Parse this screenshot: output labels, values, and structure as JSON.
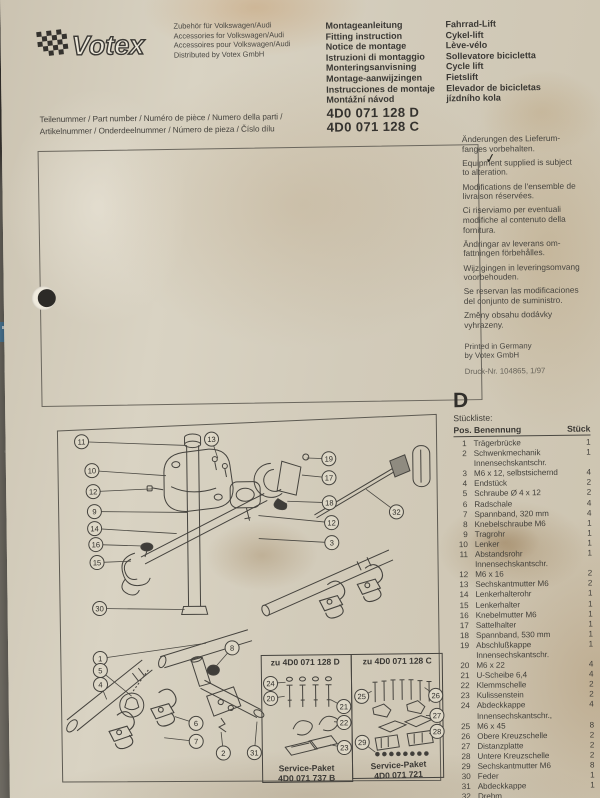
{
  "header": {
    "brand": "Votex",
    "distributor_lines": [
      "Zubehör für Volkswagen/Audi",
      "Accessories for Volkswagen/Audi",
      "Accessoires pour Volkswagen/Audi",
      "Distributed by Votex GmbH"
    ],
    "instruction_titles": [
      "Montageanleitung",
      "Fitting instruction",
      "Notice de montage",
      "Istruzioni di montaggio",
      "Monteringsanvisning",
      "Montage-aanwijzingen",
      "Instrucciones de montaje",
      "Montážní návod"
    ],
    "product_names": [
      "Fahrrad-Lift",
      "Cykel-lift",
      "Lève-vélo",
      "Sollevatore bicicletta",
      "Cycle lift",
      "Fietslift",
      "Elevador de bicicletas",
      "jízdního kola"
    ],
    "part_number_labels": [
      "Teilenummer / Part number / Numéro de pièce / Numero della parti /",
      "Artikelnummer / Onderdeelnummer / Número de pieza / Číslo dílu"
    ],
    "part_numbers": [
      "4D0 071 128 D",
      "4D0 071 128 C"
    ]
  },
  "notices": {
    "paragraphs": [
      "Änderungen des Lieferum-\nfanges vorbehalten.",
      "Equipment supplied is subject\nto alteration.",
      "Modifications de l'ensemble de\nlivraison réservées.",
      "Ci riserviamo per eventuali\nmodifiche al contenuto della\nfornitura.",
      "Ändringar av leverans om-\nfattningen förbehålles.",
      "Wijzigingen in leveringsomvang\nvoorbehouden.",
      "Se reservan las modificaciones\ndel conjunto de suministro.",
      "Změny obsahu dodávky\nvyhrazeny."
    ],
    "printed": "Printed in Germany\nby Votex GmbH",
    "print_number": "Druck-Nr. 104865, 1/97"
  },
  "parts_list": {
    "section_letter": "D",
    "title": "Stückliste:",
    "col_pos_name": "Pos. Benennung",
    "col_qty": "Stück",
    "rows": [
      {
        "pos": "1",
        "name": "Trägerbrücke",
        "qty": "1"
      },
      {
        "pos": "2",
        "name": "Schwenkmechanik",
        "qty": "1"
      },
      {
        "pos": "3",
        "name": "Innensechskantschr.\nM6 x 12, selbstsichernd",
        "qty": "4"
      },
      {
        "pos": "4",
        "name": "Endstück",
        "qty": "2"
      },
      {
        "pos": "5",
        "name": "Schraube Ø 4 x 12",
        "qty": "2"
      },
      {
        "pos": "6",
        "name": "Radschale",
        "qty": "4"
      },
      {
        "pos": "7",
        "name": "Spannband, 320 mm",
        "qty": "4"
      },
      {
        "pos": "8",
        "name": "Knebelschraube M6",
        "qty": "1"
      },
      {
        "pos": "9",
        "name": "Tragrohr",
        "qty": "1"
      },
      {
        "pos": "10",
        "name": "Lenker",
        "qty": "1"
      },
      {
        "pos": "11",
        "name": "Abstandsrohr",
        "qty": "1"
      },
      {
        "pos": "12",
        "name": "Innensechskantschr.\nM6 x 16",
        "qty": "2"
      },
      {
        "pos": "13",
        "name": "Sechskantmutter M6",
        "qty": "2"
      },
      {
        "pos": "14",
        "name": "Lenkerhalterohr",
        "qty": "1"
      },
      {
        "pos": "15",
        "name": "Lenkerhalter",
        "qty": "1"
      },
      {
        "pos": "16",
        "name": "Knebelmutter M6",
        "qty": "1"
      },
      {
        "pos": "17",
        "name": "Sattelhalter",
        "qty": "1"
      },
      {
        "pos": "18",
        "name": "Spannband, 530 mm",
        "qty": "1"
      },
      {
        "pos": "19",
        "name": "Abschlußkappe",
        "qty": "1"
      },
      {
        "pos": "20",
        "name": "Innensechskantschr.\nM6 x 22",
        "qty": "4"
      },
      {
        "pos": "21",
        "name": "U-Scheibe 6,4",
        "qty": "4"
      },
      {
        "pos": "22",
        "name": "Klemmschelle",
        "qty": "2"
      },
      {
        "pos": "23",
        "name": "Kulissenstein",
        "qty": "2"
      },
      {
        "pos": "24",
        "name": "Abdeckkappe",
        "qty": "4"
      },
      {
        "pos": "25",
        "name": "Innensechskantschr.,\nM6 x 45",
        "qty": "8"
      },
      {
        "pos": "26",
        "name": "Obere Kreuzschelle",
        "qty": "2"
      },
      {
        "pos": "27",
        "name": "Distanzplatte",
        "qty": "2"
      },
      {
        "pos": "28",
        "name": "Untere Kreuzschelle",
        "qty": "2"
      },
      {
        "pos": "29",
        "name": "Sechskantmutter M6",
        "qty": "8"
      },
      {
        "pos": "30",
        "name": "Feder",
        "qty": "1"
      },
      {
        "pos": "31",
        "name": "Abdeckkappe",
        "qty": "1"
      },
      {
        "pos": "32",
        "name": "Drehm",
        "qty": ""
      }
    ]
  },
  "diagram": {
    "service_box_d": {
      "title": "zu 4D0 071 128 D",
      "label1": "Service-Paket",
      "label2": "4D0 071 737 B"
    },
    "service_box_c": {
      "title": "zu 4D0 071 128 C",
      "label1": "Service-Paket",
      "label2": "4D0 071 721"
    },
    "callouts": [
      {
        "n": "11",
        "x": 76,
        "y": 444,
        "tx": 181,
        "ty": 449
      },
      {
        "n": "13",
        "x": 206,
        "y": 443,
        "tx": 212,
        "ty": 462
      },
      {
        "n": "10",
        "x": 86,
        "y": 473,
        "tx": 160,
        "ty": 479
      },
      {
        "n": "12",
        "x": 87,
        "y": 494,
        "tx": 146,
        "ty": 492
      },
      {
        "n": "9",
        "x": 88,
        "y": 514,
        "tx": 181,
        "ty": 516
      },
      {
        "n": "14",
        "x": 88,
        "y": 531,
        "tx": 170,
        "ty": 537
      },
      {
        "n": "16",
        "x": 89,
        "y": 547,
        "tx": 136,
        "ty": 549
      },
      {
        "n": "15",
        "x": 90,
        "y": 565,
        "tx": 124,
        "ty": 564
      },
      {
        "n": "30",
        "x": 92,
        "y": 611,
        "tx": 177,
        "ty": 613
      },
      {
        "n": "1",
        "x": 92,
        "y": 661,
        "tx": 198,
        "ty": 647
      },
      {
        "n": "5",
        "x": 92,
        "y": 673,
        "tx": 123,
        "ty": 699
      },
      {
        "n": "4",
        "x": 92,
        "y": 687,
        "tx": 98,
        "ty": 702
      },
      {
        "n": "8",
        "x": 224,
        "y": 652,
        "tx": 207,
        "ty": 671
      },
      {
        "n": "6",
        "x": 187,
        "y": 727,
        "tx": 166,
        "ty": 720
      },
      {
        "n": "7",
        "x": 187,
        "y": 745,
        "tx": 155,
        "ty": 741
      },
      {
        "n": "2",
        "x": 214,
        "y": 757,
        "tx": 212,
        "ty": 736
      },
      {
        "n": "31",
        "x": 245,
        "y": 757,
        "tx": 248,
        "ty": 726
      },
      {
        "n": "19",
        "x": 323,
        "y": 464,
        "tx": 301,
        "ty": 463
      },
      {
        "n": "17",
        "x": 323,
        "y": 483,
        "tx": 296,
        "ty": 480
      },
      {
        "n": "18",
        "x": 323,
        "y": 508,
        "tx": 281,
        "ty": 506
      },
      {
        "n": "12",
        "x": 325,
        "y": 528,
        "tx": 252,
        "ty": 520
      },
      {
        "n": "3",
        "x": 325,
        "y": 548,
        "tx": 252,
        "ty": 543
      },
      {
        "n": "32",
        "x": 390,
        "y": 518,
        "tx": 360,
        "ty": 495
      },
      {
        "n": "24",
        "x": 262,
        "y": 688,
        "tx": 277,
        "ty": 687
      },
      {
        "n": "20",
        "x": 262,
        "y": 703,
        "tx": 276,
        "ty": 701
      },
      {
        "n": "21",
        "x": 335,
        "y": 712,
        "tx": 322,
        "ty": 705
      },
      {
        "n": "22",
        "x": 335,
        "y": 728,
        "tx": 325,
        "ty": 727
      },
      {
        "n": "23",
        "x": 335,
        "y": 753,
        "tx": 321,
        "ty": 750
      },
      {
        "n": "25",
        "x": 353,
        "y": 702,
        "tx": 363,
        "ty": 697
      },
      {
        "n": "26",
        "x": 427,
        "y": 702,
        "tx": 416,
        "ty": 694
      },
      {
        "n": "27",
        "x": 428,
        "y": 722,
        "tx": 417,
        "ty": 722
      },
      {
        "n": "28",
        "x": 428,
        "y": 738,
        "tx": 420,
        "ty": 740
      },
      {
        "n": "29",
        "x": 353,
        "y": 748,
        "tx": 366,
        "ty": 758
      }
    ]
  }
}
